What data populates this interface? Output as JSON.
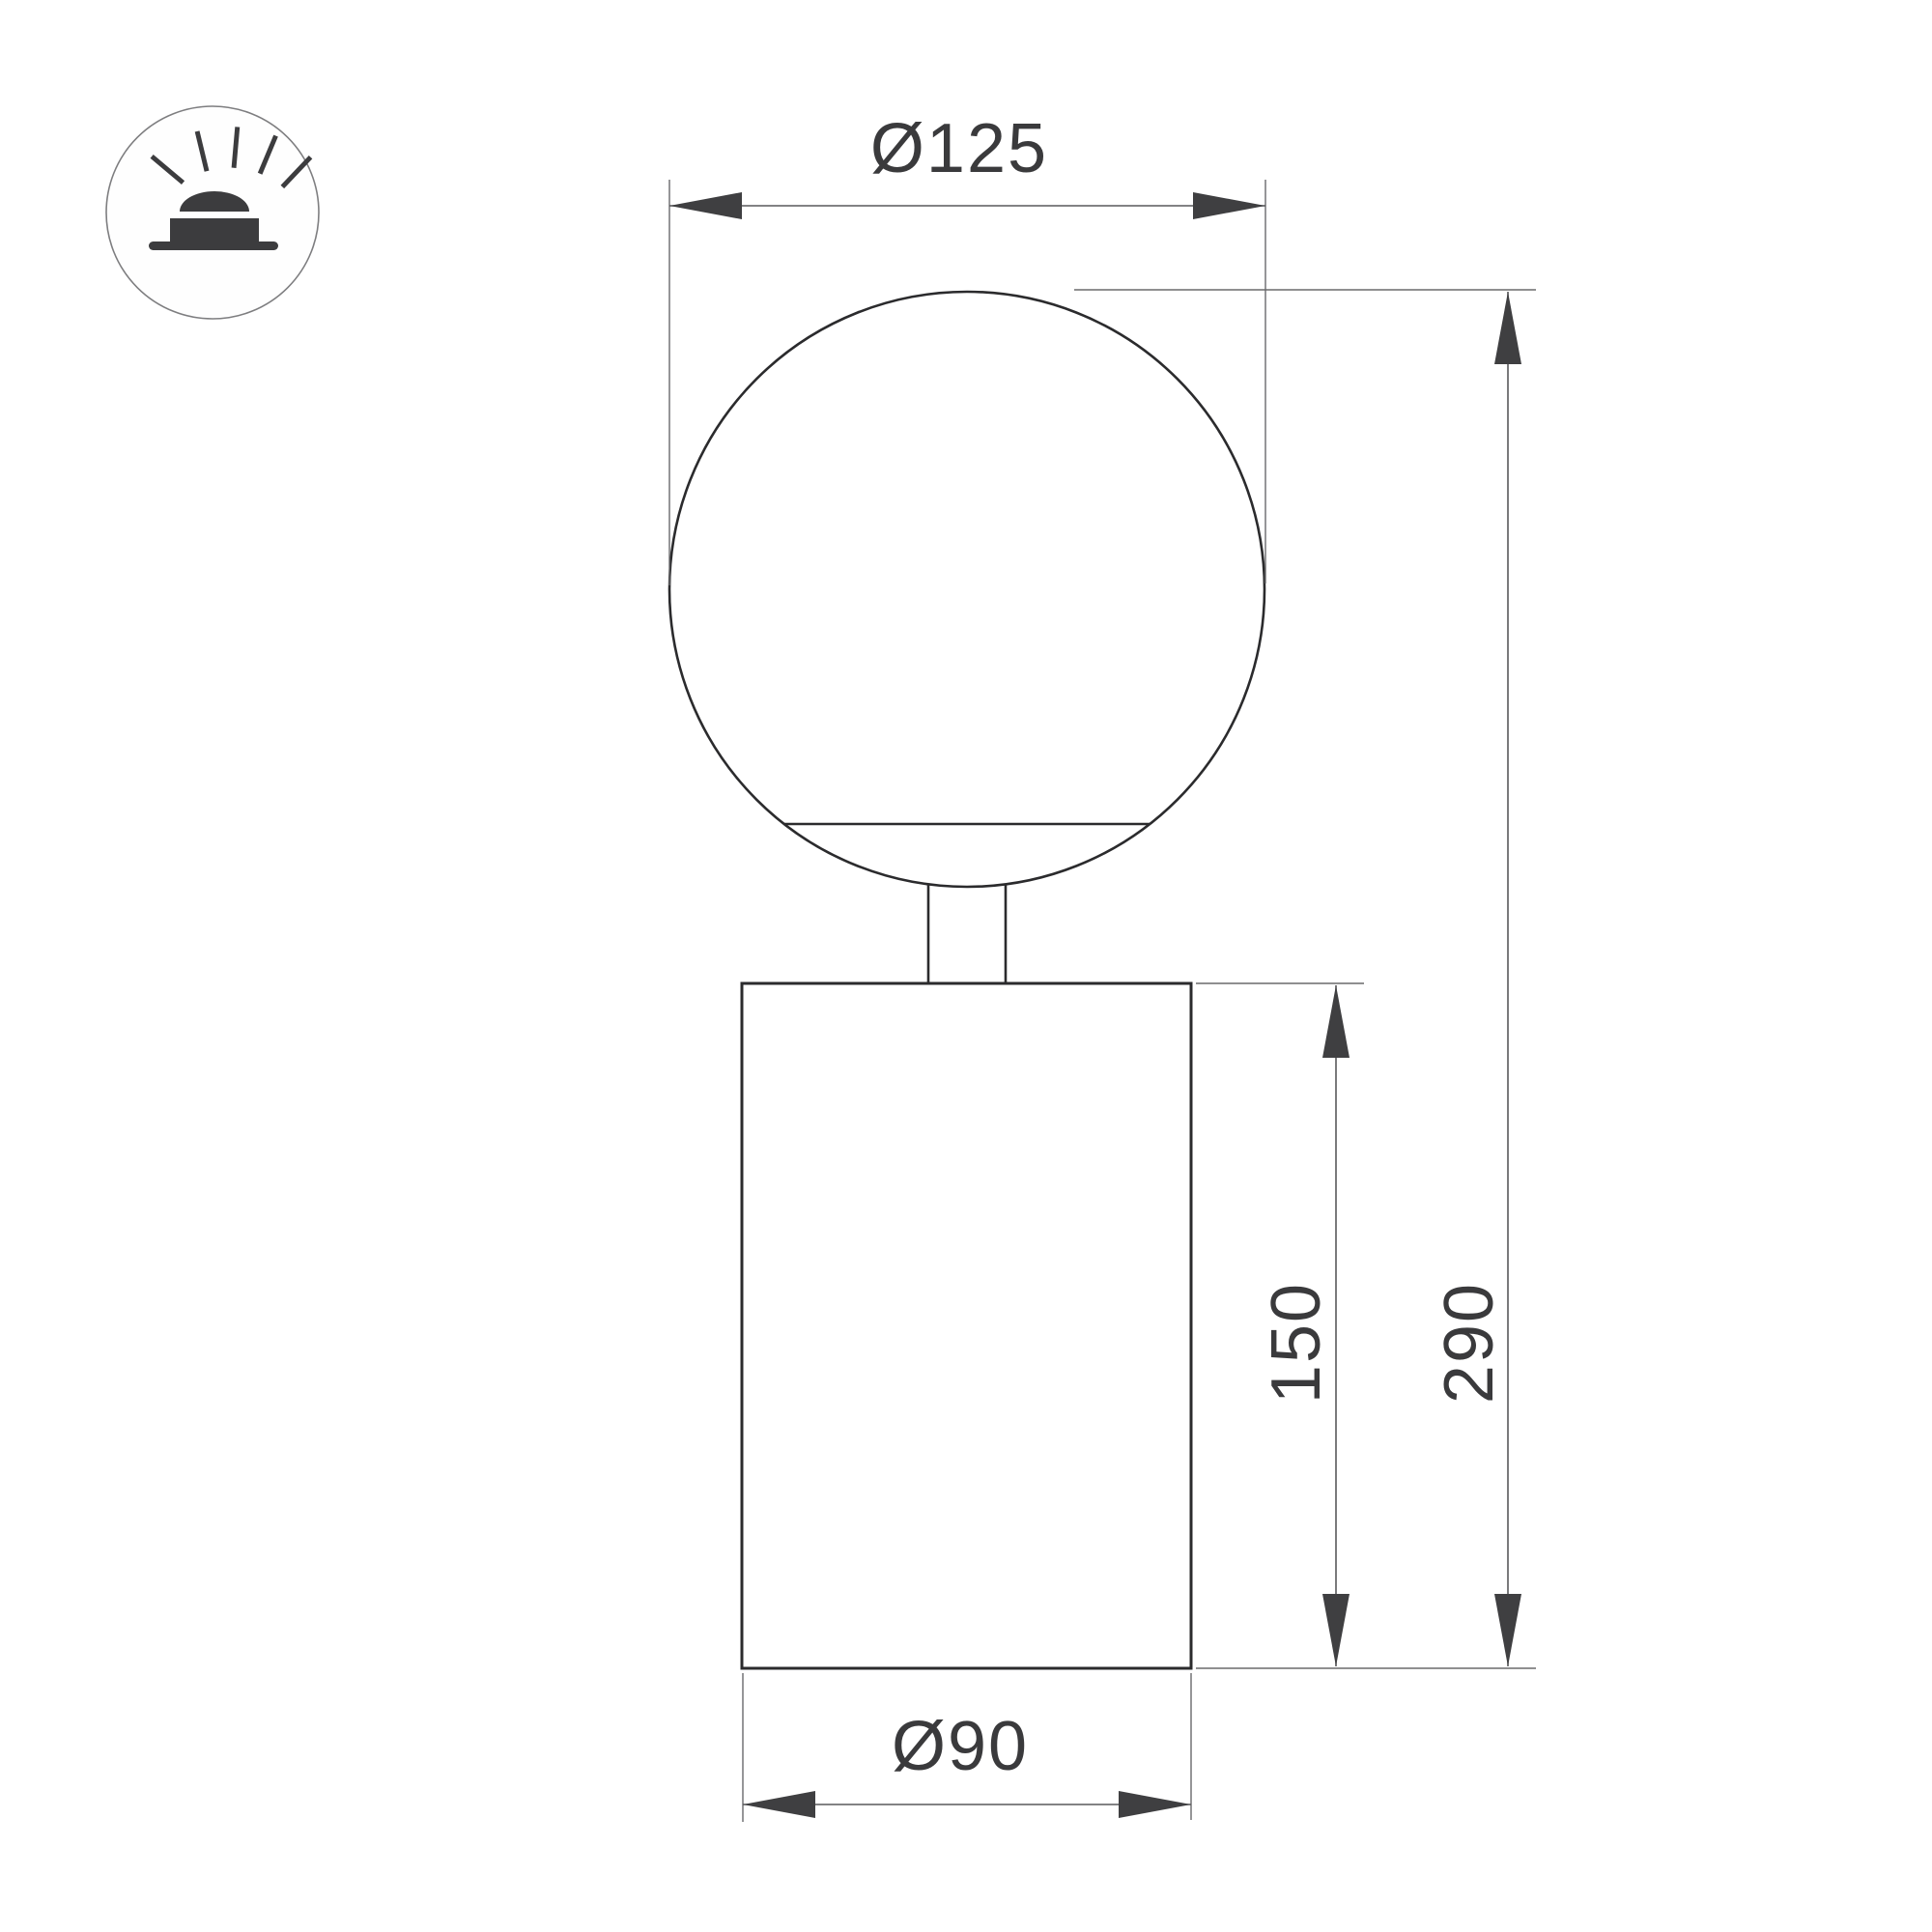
{
  "drawing": {
    "title": "Globe table luminaire dimension drawing",
    "dimensions": {
      "globe_diameter": "Ø125",
      "overall_height": "290",
      "body_height": "150",
      "body_diameter": "Ø90"
    },
    "icon": {
      "name": "surface-mounted-light-icon"
    },
    "colors": {
      "background": "#ffffff",
      "object_line": "#2b2b2d",
      "dimension_line": "#59595b",
      "arrow_fill": "#3f3f41",
      "label_text": "#3a3a3c",
      "icon_fill": "#3c3c3e",
      "icon_ring_stroke": "#7e7e80"
    }
  }
}
